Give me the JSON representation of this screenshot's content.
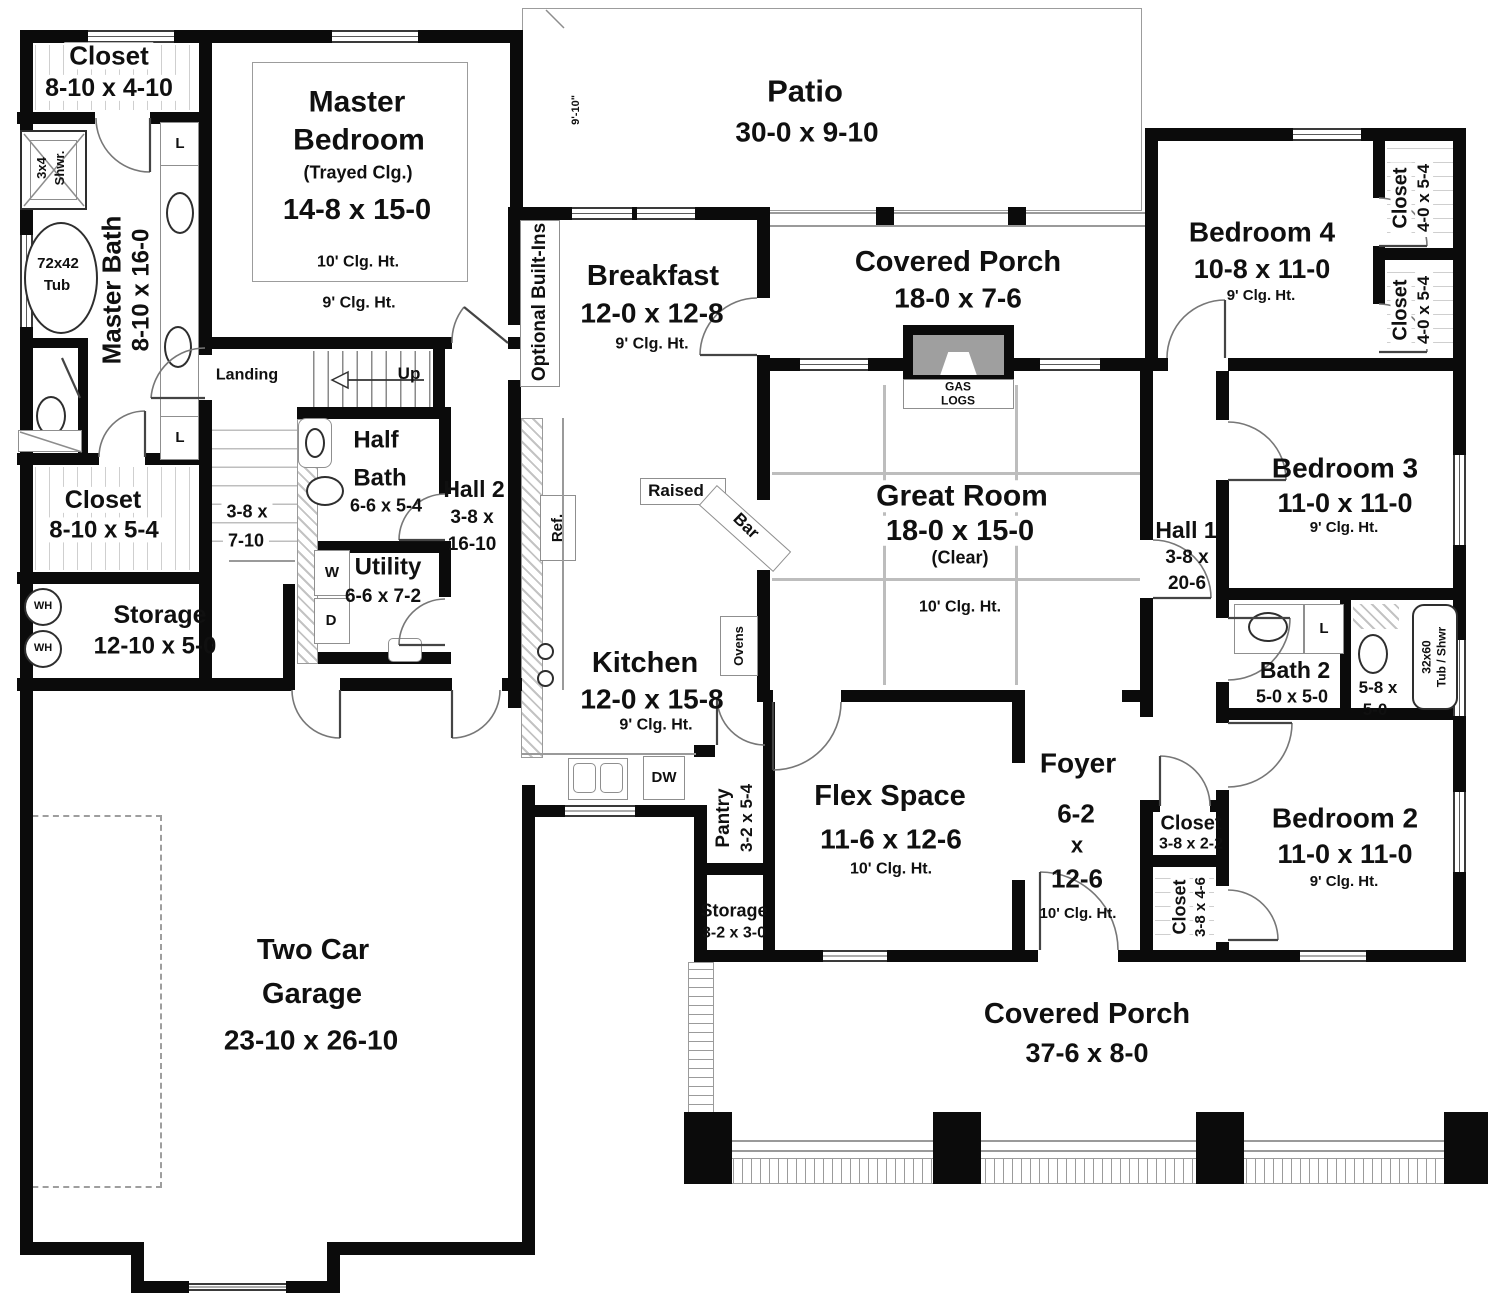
{
  "rooms": {
    "patio": {
      "name": "Patio",
      "dims": "30-0 x 9-10",
      "depth": "9'-10\""
    },
    "master_bedroom": {
      "n1": "Master",
      "n2": "Bedroom",
      "note": "(Trayed Clg.)",
      "dims": "14-8 x 15-0",
      "ceil": "10' Clg. Ht.",
      "ceil2": "9' Clg. Ht."
    },
    "master_closet": {
      "name": "Closet",
      "dims": "8-10 x 4-10"
    },
    "master_bath": {
      "name": "Master Bath",
      "dims": "8-10 x 16-0"
    },
    "shower": {
      "l1": "3x4",
      "l2": "Shwr."
    },
    "tub": {
      "l1": "72x42",
      "l2": "Tub"
    },
    "closet2": {
      "name": "Closet",
      "dims": "8-10 x 5-4"
    },
    "storage_rear": {
      "name": "Storage",
      "dims": "12-10 x 5-0"
    },
    "stairwell": {
      "d1": "3-8 x",
      "d2": "7-10"
    },
    "landing": "Landing",
    "up": "Up",
    "half_bath": {
      "n1": "Half",
      "n2": "Bath",
      "dims": "6-6 x 5-4"
    },
    "utility": {
      "name": "Utility",
      "dims": "6-6 x 7-2"
    },
    "hall2": {
      "name": "Hall 2",
      "d1": "3-8 x",
      "d2": "16-10"
    },
    "optional": "Optional Built-Ins",
    "breakfast": {
      "name": "Breakfast",
      "dims": "12-0 x 12-8",
      "ceil": "9' Clg. Ht."
    },
    "porch_rear": {
      "name": "Covered Porch",
      "dims": "18-0 x 7-6"
    },
    "gas_logs": {
      "l1": "GAS",
      "l2": "LOGS"
    },
    "great_room": {
      "name": "Great Room",
      "dims": "18-0 x 15-0",
      "note": "(Clear)",
      "ceil": "10' Clg. Ht."
    },
    "bedroom4": {
      "name": "Bedroom 4",
      "dims": "10-8 x 11-0",
      "ceil": "9' Clg. Ht."
    },
    "closet_b4a": {
      "name": "Closet",
      "dims": "4-0 x 5-4"
    },
    "closet_b4b": {
      "name": "Closet",
      "dims": "4-0 x 5-4"
    },
    "bedroom3": {
      "name": "Bedroom 3",
      "dims": "11-0 x 11-0",
      "ceil": "9' Clg. Ht."
    },
    "hall1": {
      "name": "Hall 1",
      "d1": "3-8 x",
      "d2": "20-6"
    },
    "kitchen": {
      "name": "Kitchen",
      "dims": "12-0 x 15-8",
      "ceil": "9' Clg. Ht."
    },
    "raised_bar": {
      "l1": "Raised",
      "l2": "Bar"
    },
    "pantry": {
      "name": "Pantry",
      "dims": "3-2 x 5-4"
    },
    "storage_front": {
      "name": "Storage",
      "dims": "3-2 x 3-0"
    },
    "flex": {
      "name": "Flex Space",
      "dims": "11-6 x 12-6",
      "ceil": "10' Clg. Ht."
    },
    "foyer": {
      "name": "Foyer",
      "d1": "6-2",
      "d2": "x",
      "d3": "12-6",
      "ceil": "10' Clg. Ht."
    },
    "closet_foyer": {
      "name": "Closet",
      "dims": "3-8 x 2-2"
    },
    "closet_b2": {
      "name": "Closet",
      "dims": "3-8 x 4-6"
    },
    "bedroom2": {
      "name": "Bedroom 2",
      "dims": "11-0 x 11-0",
      "ceil": "9' Clg. Ht."
    },
    "bath2": {
      "name": "Bath 2",
      "dims": "5-0 x 5-0"
    },
    "bath2_wc": {
      "d1": "5-8 x",
      "d2": "5-0"
    },
    "tub2": {
      "l1": "32x60",
      "l2": "Tub / Shwr"
    },
    "garage": {
      "n1": "Two Car",
      "n2": "Garage",
      "dims": "23-10 x 26-10"
    },
    "porch_front": {
      "name": "Covered Porch",
      "dims": "37-6 x 8-0"
    }
  },
  "fixtures": {
    "wh": "WH",
    "washer": "W",
    "dryer": "D",
    "linen": "L",
    "ref": "Ref.",
    "ovens": "Ovens",
    "dw": "DW"
  },
  "colors": {
    "wall": "#0b0b0b",
    "fireplace_fill": "#9f9f9f",
    "text": "#101010"
  }
}
